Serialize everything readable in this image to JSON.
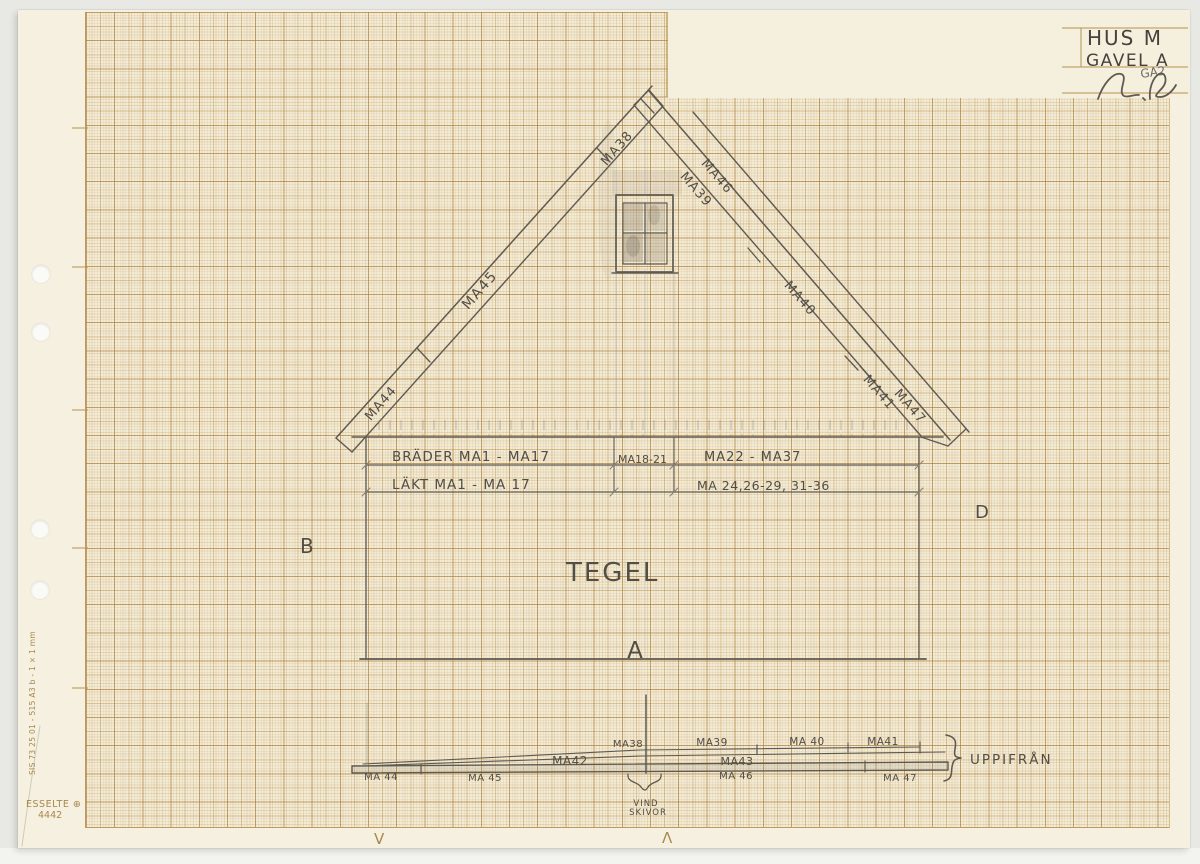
{
  "title_block": {
    "line1": "HUS M",
    "line2": "GAVEL A",
    "annotation": "GA2"
  },
  "elevation": {
    "roof_labels": {
      "ma38": "MA38",
      "ma39": "MA39",
      "ma40": "MA40",
      "ma41": "MA41",
      "ma44": "MA44",
      "ma45": "MA45",
      "ma46": "MA46",
      "ma47": "MA47"
    },
    "board_rows": {
      "row1_left": "BRÄDER MA1 - MA17",
      "row1_mid": "MA18-21",
      "row1_right": "MA22 - MA37",
      "row2_left": "LÄKT MA1 - MA 17",
      "row2_right": "MA 24,26-29, 31-36"
    },
    "wall_material": "TEGEL",
    "marker_left": "B",
    "marker_right": "D",
    "marker_bottom": "A"
  },
  "plan": {
    "view_label": "UPPIFRÅN",
    "top_row": [
      "MA38",
      "MA39",
      "MA 40",
      "MA41"
    ],
    "mid_row": [
      "MA42",
      "MA43"
    ],
    "bottom_row": [
      "MA 44",
      "MA 45",
      "MA 46",
      "MA 47"
    ],
    "note_line1": "VIND",
    "note_line2": "SKIVOR"
  },
  "paper": {
    "edge_spec": "SIS 73 25 01 - 515 A3 b - 1 × 1 mm",
    "brand": "ESSELTE ⊕",
    "brand_number": "4442",
    "fold_mark_left": "V",
    "fold_mark_right": "Λ"
  },
  "colors": {
    "background": "#e8e8e4",
    "paper": "#f6f0e0",
    "grid_major": "#c09a5c",
    "pencil": "#5f5a51",
    "print_tan": "#a8884b"
  }
}
